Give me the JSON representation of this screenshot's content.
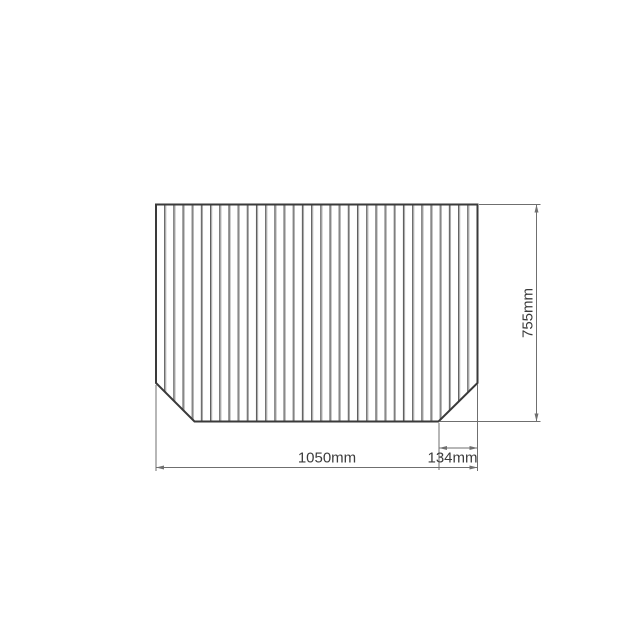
{
  "diagram": {
    "dimensions": {
      "width_label": "1050mm",
      "height_label": "755mm",
      "corner_cut_label": "134mm"
    },
    "slat_count": 35,
    "colors": {
      "background": "#ffffff",
      "outline": "#3a3a3a",
      "slat_dark": "#5f5f5f",
      "slat_light": "#ababab",
      "dimension_line": "#6f6f6f",
      "label_text": "#3c3c3c"
    }
  }
}
